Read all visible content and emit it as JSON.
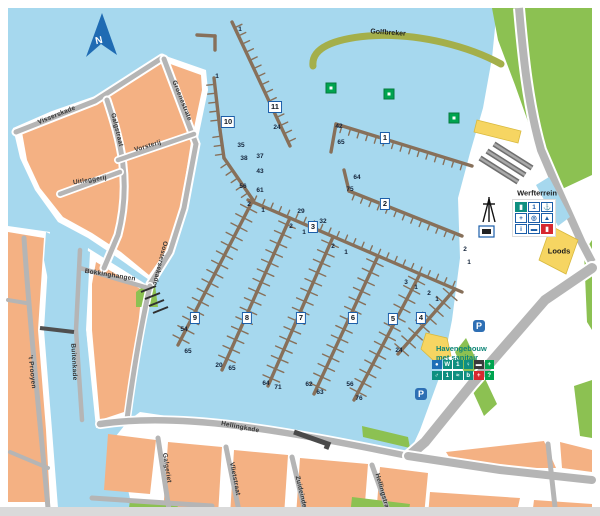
{
  "map": {
    "north_label": "N",
    "fixed_labels": {
      "golfbreker": "Golfbreker",
      "werfterrein": "Werfterrein",
      "loods": "Loods",
      "havengebouw_line1": "Havengebouw",
      "havengebouw_line2": "met sanitair"
    },
    "colors": {
      "water": "#a6d8ee",
      "land_white": "#ffffff",
      "block_orange": "#f4b183",
      "green": "#8cc152",
      "breakwater_olive": "#a4af4a",
      "pier_brown": "#87705a",
      "street_gray": "#b5b5b5",
      "label_border_blue": "#1b5ea9",
      "parking_blue": "#2e6fb4",
      "facility_teal": "#0e8f80",
      "facility_green": "#00a44f",
      "facility_red": "#d7282f",
      "north_blue": "#1f6bb3",
      "quay_dark": "#4a4a4a"
    },
    "pier_labels": [
      {
        "n": "1",
        "x": 385,
        "y": 138
      },
      {
        "n": "2",
        "x": 385,
        "y": 204
      },
      {
        "n": "3",
        "x": 313,
        "y": 227
      },
      {
        "n": "4",
        "x": 421,
        "y": 318
      },
      {
        "n": "5",
        "x": 393,
        "y": 319
      },
      {
        "n": "6",
        "x": 353,
        "y": 318
      },
      {
        "n": "7",
        "x": 301,
        "y": 318
      },
      {
        "n": "8",
        "x": 247,
        "y": 318
      },
      {
        "n": "9",
        "x": 195,
        "y": 318
      },
      {
        "n": "10",
        "x": 228,
        "y": 122
      },
      {
        "n": "11",
        "x": 275,
        "y": 107
      }
    ],
    "berth_numbers": [
      {
        "t": "1",
        "x": 217,
        "y": 77
      },
      {
        "t": "1",
        "x": 240,
        "y": 30
      },
      {
        "t": "35",
        "x": 241,
        "y": 146
      },
      {
        "t": "38",
        "x": 244,
        "y": 159
      },
      {
        "t": "37",
        "x": 260,
        "y": 157
      },
      {
        "t": "43",
        "x": 260,
        "y": 172
      },
      {
        "t": "56",
        "x": 243,
        "y": 187
      },
      {
        "t": "61",
        "x": 260,
        "y": 191
      },
      {
        "t": "24",
        "x": 277,
        "y": 128
      },
      {
        "t": "42",
        "x": 339,
        "y": 127
      },
      {
        "t": "65",
        "x": 341,
        "y": 143
      },
      {
        "t": "64",
        "x": 357,
        "y": 178
      },
      {
        "t": "75",
        "x": 350,
        "y": 190
      },
      {
        "t": "2",
        "x": 249,
        "y": 205
      },
      {
        "t": "1",
        "x": 263,
        "y": 211
      },
      {
        "t": "29",
        "x": 301,
        "y": 212
      },
      {
        "t": "32",
        "x": 323,
        "y": 222
      },
      {
        "t": "2",
        "x": 291,
        "y": 227
      },
      {
        "t": "1",
        "x": 304,
        "y": 233
      },
      {
        "t": "2",
        "x": 333,
        "y": 247
      },
      {
        "t": "1",
        "x": 346,
        "y": 253
      },
      {
        "t": "3",
        "x": 406,
        "y": 283
      },
      {
        "t": "1",
        "x": 416,
        "y": 288
      },
      {
        "t": "2",
        "x": 429,
        "y": 294
      },
      {
        "t": "1",
        "x": 437,
        "y": 300
      },
      {
        "t": "2",
        "x": 465,
        "y": 250
      },
      {
        "t": "1",
        "x": 469,
        "y": 263
      },
      {
        "t": "54",
        "x": 184,
        "y": 330
      },
      {
        "t": "65",
        "x": 188,
        "y": 352
      },
      {
        "t": "20",
        "x": 219,
        "y": 366
      },
      {
        "t": "65",
        "x": 232,
        "y": 369
      },
      {
        "t": "64",
        "x": 266,
        "y": 384
      },
      {
        "t": "71",
        "x": 278,
        "y": 388
      },
      {
        "t": "62",
        "x": 309,
        "y": 385
      },
      {
        "t": "63",
        "x": 320,
        "y": 393
      },
      {
        "t": "56",
        "x": 350,
        "y": 385
      },
      {
        "t": "76",
        "x": 359,
        "y": 399
      },
      {
        "t": "24",
        "x": 399,
        "y": 351
      }
    ],
    "street_labels": [
      {
        "t": "Visserskade",
        "x": 57,
        "y": 116,
        "r": -22
      },
      {
        "t": "Galgstraat",
        "x": 116,
        "y": 130,
        "r": 76
      },
      {
        "t": "Vorsterij",
        "x": 148,
        "y": 147,
        "r": -17
      },
      {
        "t": "Uitleggerij",
        "x": 90,
        "y": 181,
        "r": -9
      },
      {
        "t": "Groenestrate",
        "x": 181,
        "y": 101,
        "r": 68
      },
      {
        "t": "Oostersekade",
        "x": 159,
        "y": 263,
        "r": 104
      },
      {
        "t": "Bokkinghangen",
        "x": 110,
        "y": 276,
        "r": 9
      },
      {
        "t": "'t Prooyen",
        "x": 31,
        "y": 372,
        "r": 84
      },
      {
        "t": "Buitenkade",
        "x": 73,
        "y": 362,
        "r": 87
      },
      {
        "t": "Hellingkade",
        "x": 240,
        "y": 428,
        "r": 11
      },
      {
        "t": "Galgeriet",
        "x": 166,
        "y": 468,
        "r": 81
      },
      {
        "t": "Vlietstraat",
        "x": 234,
        "y": 479,
        "r": 79
      },
      {
        "t": "Zuideinde",
        "x": 300,
        "y": 492,
        "r": 77
      },
      {
        "t": "Hellingstraat",
        "x": 382,
        "y": 494,
        "r": 74
      }
    ],
    "buoys": [
      {
        "x": 331,
        "y": 88
      },
      {
        "x": 389,
        "y": 94
      },
      {
        "x": 454,
        "y": 118
      }
    ],
    "parking": [
      {
        "x": 479,
        "y": 326
      },
      {
        "x": 421,
        "y": 394
      }
    ],
    "werf_icons": [
      {
        "bg": "#0e8f80",
        "fg": "#ffffff",
        "g": "▮",
        "name": "hoist-icon"
      },
      {
        "bg": "#ffffff",
        "fg": "#1b5ea9",
        "g": "1",
        "name": "crane-icon"
      },
      {
        "bg": "#ffffff",
        "fg": "#1b5ea9",
        "g": "⚓",
        "name": "anchor-icon"
      },
      {
        "bg": "#ffffff",
        "fg": "#1b5ea9",
        "g": "+",
        "name": "service-icon"
      },
      {
        "bg": "#ffffff",
        "fg": "#1b5ea9",
        "g": "◎",
        "name": "winch-icon"
      },
      {
        "bg": "#ffffff",
        "fg": "#1b5ea9",
        "g": "▲",
        "name": "slipway-icon"
      },
      {
        "bg": "#ffffff",
        "fg": "#1b5ea9",
        "g": "i",
        "name": "info-icon"
      },
      {
        "bg": "#ffffff",
        "fg": "#1b5ea9",
        "g": "▬",
        "name": "boat-trailer-icon"
      },
      {
        "bg": "#d7282f",
        "fg": "#ffffff",
        "g": "▮",
        "name": "fuel-icon"
      }
    ],
    "haven_icons_row1": [
      {
        "bg": "#1d70b7",
        "fg": "#ffffff",
        "g": "●",
        "name": "wifi-icon"
      },
      {
        "bg": "#0e8f80",
        "fg": "#ffffff",
        "g": "W",
        "name": "wc-icon"
      },
      {
        "bg": "#0e8f80",
        "fg": "#ffffff",
        "g": "1",
        "name": "shower-icon"
      },
      {
        "bg": "#0e8f80",
        "fg": "#ffffff",
        "g": "♀",
        "name": "toilet-women-icon"
      },
      {
        "bg": "#3b3b3b",
        "fg": "#ffffff",
        "g": "▬",
        "name": "laundry-icon"
      },
      {
        "bg": "#00a44f",
        "fg": "#ffffff",
        "g": "+",
        "name": "first-aid-icon"
      }
    ],
    "haven_icons_row2": [
      {
        "bg": "#0e8f80",
        "fg": "#ffffff",
        "g": "♂",
        "name": "toilet-men-icon"
      },
      {
        "bg": "#0e8f80",
        "fg": "#ffffff",
        "g": "1",
        "name": "washstand-icon"
      },
      {
        "bg": "#0e8f80",
        "fg": "#ffffff",
        "g": "≈",
        "name": "water-icon"
      },
      {
        "bg": "#0e8f80",
        "fg": "#ffffff",
        "g": "b",
        "name": "dishwash-icon"
      },
      {
        "bg": "#d7282f",
        "fg": "#ffffff",
        "g": "+",
        "name": "defibrillator-icon"
      },
      {
        "bg": "#00a44f",
        "fg": "#ffffff",
        "g": "?",
        "name": "info-point-icon"
      }
    ]
  }
}
